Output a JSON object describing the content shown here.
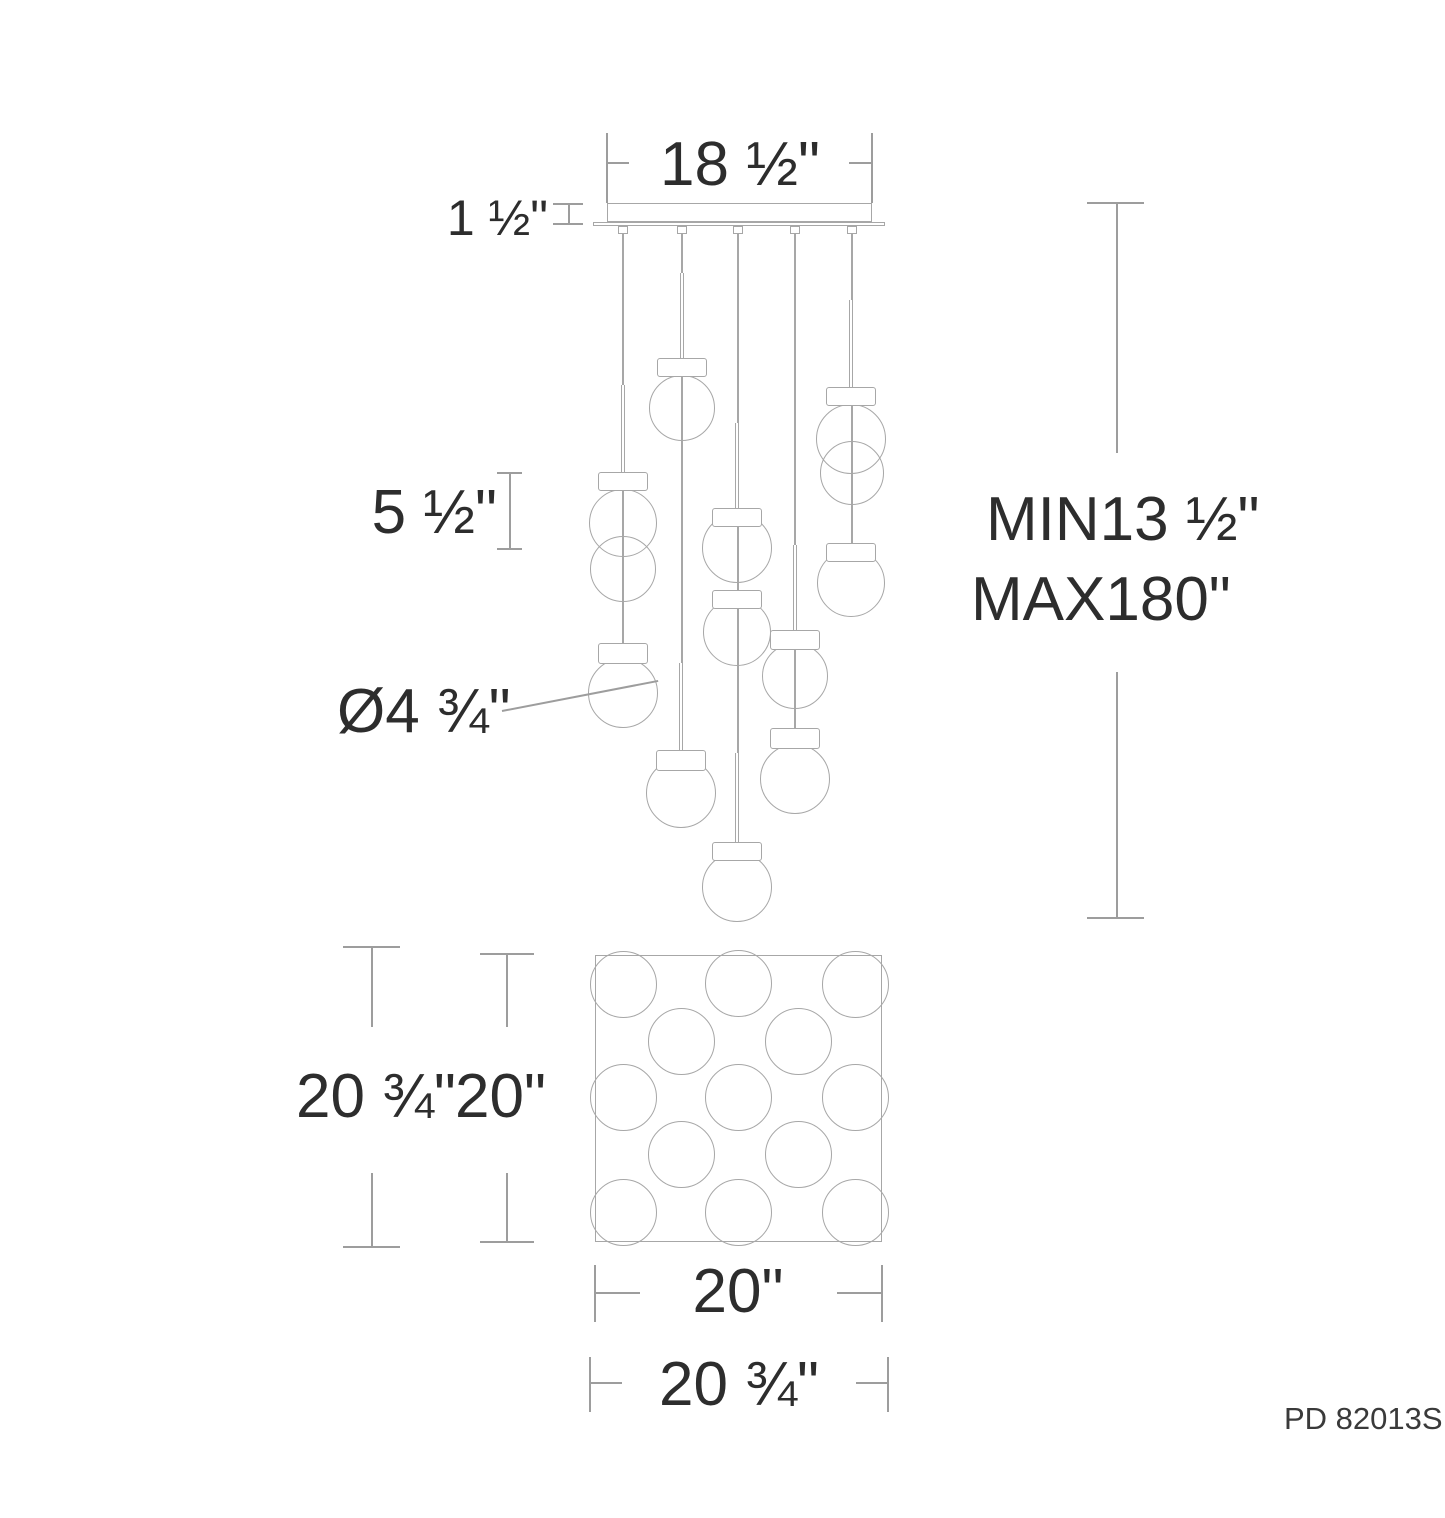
{
  "diagram": {
    "part_number": "PD 82013S",
    "dimensions": {
      "canopy_width": "18 ½\"",
      "canopy_height": "1 ½\"",
      "unit_height": "5 ½\"",
      "globe_diameter": "Ø4 ¾\"",
      "suspension_min": "MIN13 ½\"",
      "suspension_max": "MAX180\"",
      "plan_side_overall": "20 ¾\"",
      "plan_side": "20\"",
      "plan_bottom_width": "20\"",
      "plan_bottom_overall": "20 ¾\""
    }
  }
}
